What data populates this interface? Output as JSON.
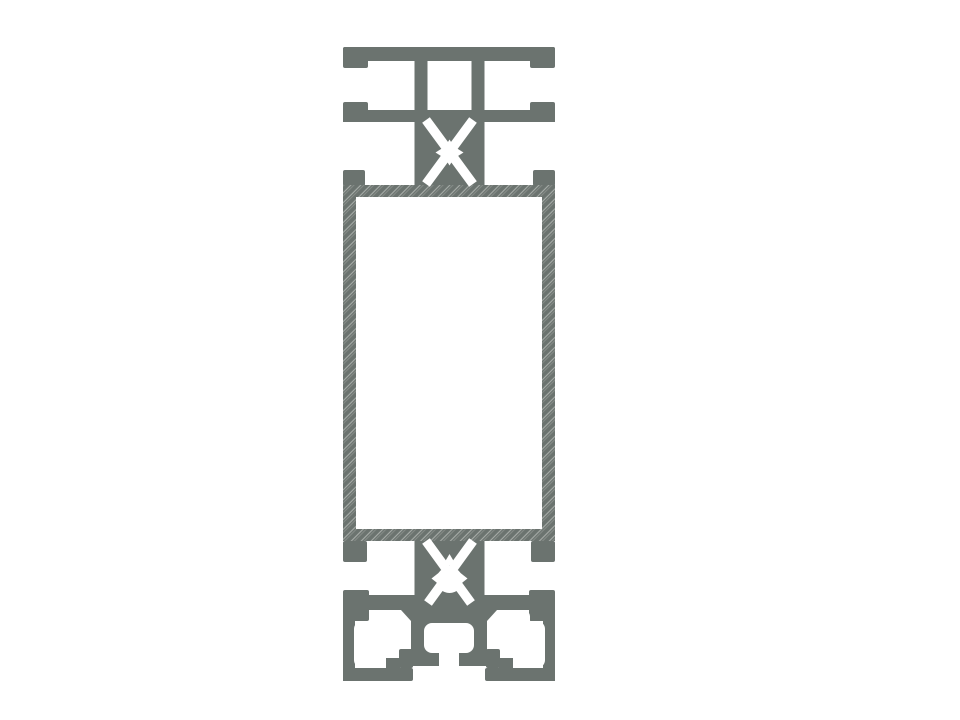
{
  "figure": {
    "alt": "Cross-section technical drawing of an aluminum T-slot extrusion profile: top T-slot section, hollow rectangular tube with hatched cut walls, and bottom base section with slot cavities",
    "components": {
      "top": "t-slot-flange-section",
      "middle": "hollow-rectangular-tube-section",
      "bottom": "base-section-with-slot-cavities",
      "screw_channel": "x-slit-screw-channel"
    }
  },
  "colors": {
    "profile": "#6b736f",
    "background": "#ffffff",
    "hatch_line": "#a7aca8",
    "hatch_line_faint": "#8d938f"
  }
}
